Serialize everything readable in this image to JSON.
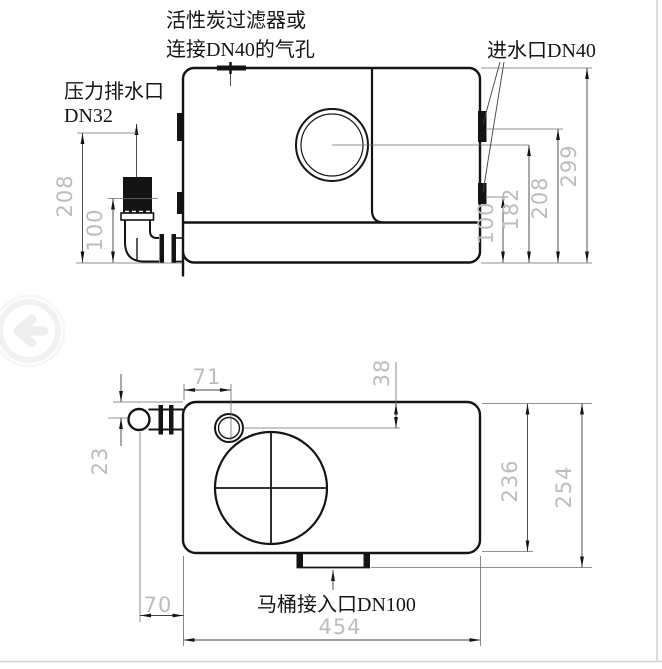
{
  "page": {
    "background": "#ffffff",
    "border_color": "#d4d4d4"
  },
  "colors": {
    "line": "#141414",
    "dim_line": "#3f3f3f",
    "dim_text": "#bcbcbc",
    "watermark": "#efefef"
  },
  "side_view": {
    "labels": {
      "vent_line1": "活性炭过滤器或",
      "vent_line2": "连接DN40的气孔",
      "pressure_outlet_line1": "压力排水口",
      "pressure_outlet_line2": "DN32",
      "inlet": "进水口DN40"
    },
    "dimensions": {
      "left_208": "208",
      "left_100": "100",
      "right_100": "100",
      "right_182": "182",
      "right_208": "208",
      "right_299": "299"
    }
  },
  "top_view": {
    "labels": {
      "toilet_inlet": "马桶接入口DN100"
    },
    "dimensions": {
      "d71": "71",
      "d38": "38",
      "d23": "23",
      "d236": "236",
      "d254": "254",
      "d70": "70",
      "d454": "454"
    }
  },
  "icons": {
    "back_arrow": "←"
  }
}
